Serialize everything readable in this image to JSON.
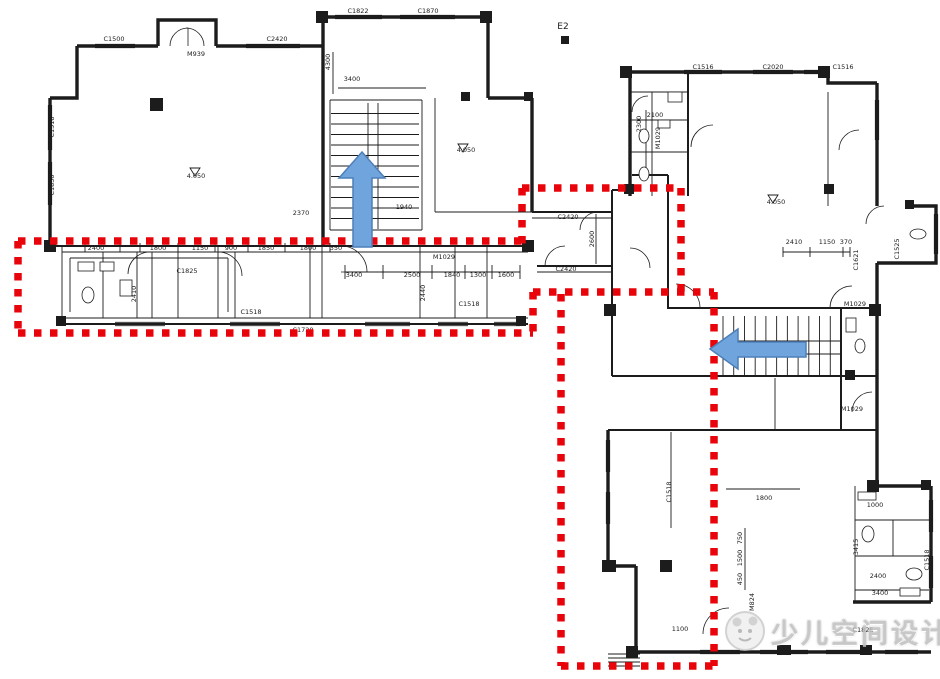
{
  "watermark": {
    "text": "少儿空间设计"
  },
  "colors": {
    "ink": "#1c1c1c",
    "highlight_red": "#e8040a",
    "arrow_blue": "#6fa4dc",
    "arrow_border": "#4e7fb8",
    "watermark_gray": "#bcbcbc",
    "background": "#ffffff"
  },
  "annotations": {
    "red_outline": {
      "color": "#e8040a",
      "segments": [
        [
          18,
          241,
          522,
          241
        ],
        [
          18,
          241,
          18,
          333
        ],
        [
          18,
          333,
          533,
          333
        ],
        [
          522,
          188,
          522,
          246
        ],
        [
          522,
          188,
          681,
          188
        ],
        [
          681,
          188,
          681,
          296
        ],
        [
          533,
          292,
          714,
          292
        ],
        [
          533,
          292,
          533,
          333
        ],
        [
          714,
          292,
          714,
          666
        ],
        [
          561,
          294,
          561,
          666
        ],
        [
          561,
          666,
          714,
          666
        ]
      ]
    },
    "arrows": [
      {
        "name": "stair-up-arrow",
        "direction": "up",
        "d": "M362,152 L385,178 L372,178 L372,247 L353,247 L353,178 L339,178 Z"
      },
      {
        "name": "stair-left-arrow",
        "direction": "left",
        "d": "M710,349 L738,329 L738,342 L806,342 L806,357 L738,357 L738,369 Z"
      }
    ]
  },
  "plan": {
    "walls_thick": [
      "M77,46 H158",
      "M216,46 H323",
      "M158,46 V20 H216 V46",
      "M77,46 V98 H50",
      "M50,98 V246",
      "M323,17 H488",
      "M323,17 V246",
      "M488,17 V98",
      "M488,98 H532",
      "M532,98 V212",
      "M632,72 H828",
      "M630,72 V196",
      "M828,72 V83 H877",
      "M877,83 V206",
      "M877,263 V486",
      "M905,206 H936 V263 H877",
      "M869,486 H931",
      "M931,486 V602",
      "M853,602 H931",
      "M608,430 V566",
      "M608,566 H636",
      "M636,566 V652",
      "M636,652 H931"
    ],
    "walls_medium": [
      "M50,246 H532",
      "M62,324 H528",
      "M532,212 H612",
      "M537,266 H612",
      "M612,190 V313",
      "M612,190 H632",
      "M668,175 V308",
      "M632,175 H668",
      "M667,308 H877",
      "M612,313 V376",
      "M612,376 H877",
      "M608,430 H877",
      "M688,72 V196",
      "M841,308 V430"
    ],
    "walls_thin": [
      "M62,252 H528",
      "M62,318 H528",
      "M62,246 V324",
      "M103,252 V318",
      "M137,252 V318",
      "M152,252 V318",
      "M178,252 V318",
      "M218,246 V318",
      "M235,252 V318",
      "M310,246 V318",
      "M322,246 V318",
      "M420,246 V318",
      "M455,246 V318",
      "M487,246 V318",
      "M70,258 H228",
      "M70,258 V312",
      "M228,258 V312",
      "M330,100 H422",
      "M330,100 V230",
      "M422,100 V230",
      "M330,230 H422",
      "M435,98 V212",
      "M435,212 H532",
      "M532,218 H612",
      "M537,272 H612",
      "M630,92 H688",
      "M652,92 V196",
      "M630,120 H688",
      "M630,152 H688",
      "M828,92 V206",
      "M775,378 V430",
      "M855,486 V602",
      "M855,520 H931",
      "M855,556 H931",
      "M893,520 V556",
      "M671,432 V528",
      "M723,316 V376",
      "M841,316 V376",
      "M608,654 H640",
      "M608,658 H640",
      "M608,662 H640",
      "M608,666 H640",
      "M338,88 H426",
      "M333,52 V94",
      "M783,252 H850",
      "M855,590 H929",
      "M726,489 H800",
      "M596,214 V264",
      "M646,110 V178",
      "M345,272 H520",
      "M745,528 V590",
      "M85,243 V252",
      "M120,243 V252",
      "M140,243 V252",
      "M178,243 V252",
      "M215,243 V252",
      "M248,243 V252",
      "M285,243 V252",
      "M330,243 V252",
      "M345,265 V279",
      "M383,265 V279",
      "M432,265 V279",
      "M465,265 V279",
      "M492,265 V279",
      "M520,265 V279",
      "M783,247 V257",
      "M810,247 V257",
      "M843,247 V257",
      "M850,247 V257",
      "M190,168 h10 l-5,8 z",
      "M458,144 h10 l-5,8 z",
      "M768,195 h10 l-5,8 z"
    ],
    "windows": [
      [
        95,
        46,
        135,
        46
      ],
      [
        246,
        46,
        300,
        46
      ],
      [
        335,
        17,
        382,
        17
      ],
      [
        400,
        17,
        455,
        17
      ],
      [
        50,
        105,
        50,
        150
      ],
      [
        50,
        162,
        50,
        205
      ],
      [
        115,
        324,
        165,
        324
      ],
      [
        230,
        324,
        280,
        324
      ],
      [
        365,
        324,
        410,
        324
      ],
      [
        438,
        324,
        468,
        324
      ],
      [
        494,
        324,
        520,
        324
      ],
      [
        684,
        72,
        722,
        72
      ],
      [
        753,
        72,
        793,
        72
      ],
      [
        804,
        72,
        826,
        72
      ],
      [
        877,
        100,
        877,
        140
      ],
      [
        936,
        214,
        936,
        254
      ],
      [
        608,
        440,
        608,
        472
      ],
      [
        608,
        492,
        608,
        524
      ],
      [
        931,
        500,
        931,
        532
      ],
      [
        931,
        556,
        931,
        588
      ],
      [
        700,
        652,
        740,
        652
      ],
      [
        760,
        652,
        808,
        652
      ],
      [
        826,
        652,
        868,
        652
      ],
      [
        885,
        652,
        918,
        652
      ]
    ],
    "doors": [
      "M170,46 A18,18 0 0,1 188,28 L188,46",
      "M204,46 A18,18 0 0,0 186,28",
      "M341,246 A26,26 0 0,1 367,272 L341,272",
      "M150,252 A22,22 0 0,0 128,274",
      "M218,252 A24,24 0 0,1 242,276",
      "M545,266 A20,20 0 0,1 565,246",
      "M598,212 A18,18 0 0,0 580,230",
      "M700,308 A24,24 0 0,0 676,284",
      "M830,308 A22,22 0 0,1 852,286",
      "M650,268 A20,20 0 0,0 630,248",
      "M691,147 A22,22 0 0,1 713,125",
      "M839,150 A20,20 0 0,1 859,130",
      "M852,412 A20,20 0 0,1 872,392",
      "M703,634 A26,26 0 0,1 729,608",
      "M648,96 A16,16 0 0,0 632,112",
      "M884,206 A18,18 0 0,0 866,224"
    ],
    "columns": [
      [
        150,
        98,
        13,
        13
      ],
      [
        316,
        11,
        12,
        12
      ],
      [
        480,
        11,
        12,
        12
      ],
      [
        44,
        240,
        12,
        12
      ],
      [
        522,
        240,
        12,
        12
      ],
      [
        56,
        316,
        10,
        10
      ],
      [
        516,
        316,
        10,
        10
      ],
      [
        620,
        66,
        12,
        12
      ],
      [
        818,
        66,
        12,
        12
      ],
      [
        624,
        184,
        10,
        10
      ],
      [
        824,
        184,
        10,
        10
      ],
      [
        604,
        304,
        12,
        12
      ],
      [
        869,
        304,
        12,
        12
      ],
      [
        602,
        560,
        14,
        12
      ],
      [
        660,
        560,
        12,
        12
      ],
      [
        867,
        480,
        12,
        12
      ],
      [
        921,
        480,
        10,
        10
      ],
      [
        777,
        645,
        14,
        10
      ],
      [
        860,
        645,
        12,
        10
      ],
      [
        626,
        646,
        12,
        12
      ],
      [
        561,
        36,
        8,
        8
      ],
      [
        461,
        92,
        9,
        9
      ],
      [
        524,
        92,
        9,
        9
      ],
      [
        905,
        200,
        9,
        9
      ],
      [
        845,
        370,
        10,
        10
      ]
    ],
    "fixtures": [
      {
        "s": "rect",
        "x": 78,
        "y": 262,
        "w": 16,
        "h": 9
      },
      {
        "s": "rect",
        "x": 100,
        "y": 262,
        "w": 14,
        "h": 9
      },
      {
        "s": "ellipse",
        "cx": 88,
        "cy": 295,
        "rx": 6,
        "ry": 8
      },
      {
        "s": "rect",
        "x": 120,
        "y": 280,
        "w": 12,
        "h": 16
      },
      {
        "s": "ellipse",
        "cx": 644,
        "cy": 136,
        "rx": 5,
        "ry": 7
      },
      {
        "s": "ellipse",
        "cx": 644,
        "cy": 174,
        "rx": 5,
        "ry": 7
      },
      {
        "s": "rect",
        "x": 658,
        "y": 120,
        "w": 12,
        "h": 8
      },
      {
        "s": "rect",
        "x": 668,
        "y": 92,
        "w": 14,
        "h": 10
      },
      {
        "s": "ellipse",
        "cx": 918,
        "cy": 234,
        "rx": 8,
        "ry": 5
      },
      {
        "s": "rect",
        "x": 858,
        "y": 492,
        "w": 18,
        "h": 8
      },
      {
        "s": "ellipse",
        "cx": 868,
        "cy": 534,
        "rx": 6,
        "ry": 8
      },
      {
        "s": "ellipse",
        "cx": 914,
        "cy": 574,
        "rx": 8,
        "ry": 6
      },
      {
        "s": "rect",
        "x": 900,
        "y": 588,
        "w": 20,
        "h": 8
      },
      {
        "s": "rect",
        "x": 846,
        "y": 318,
        "w": 10,
        "h": 14
      },
      {
        "s": "ellipse",
        "cx": 860,
        "cy": 346,
        "rx": 5,
        "ry": 7
      }
    ],
    "stairs": [
      {
        "x": 331,
        "y": 103,
        "w": 88,
        "h": 126,
        "dir": "v",
        "steps": 12,
        "rails": [
          368,
          378
        ]
      },
      {
        "x": 723,
        "y": 316,
        "w": 118,
        "h": 60,
        "dir": "h",
        "steps": 11,
        "rails": [
          341,
          354
        ]
      }
    ],
    "labels": [
      {
        "t": "C1500",
        "x": 114,
        "y": 41
      },
      {
        "t": "M939",
        "x": 196,
        "y": 56
      },
      {
        "t": "C2420",
        "x": 277,
        "y": 41
      },
      {
        "t": "C1822",
        "x": 358,
        "y": 13
      },
      {
        "t": "C1870",
        "x": 428,
        "y": 13
      },
      {
        "t": "E2",
        "x": 563,
        "y": 29,
        "s": 9
      },
      {
        "t": "C1516",
        "x": 703,
        "y": 69
      },
      {
        "t": "C2020",
        "x": 773,
        "y": 69
      },
      {
        "t": "C1516",
        "x": 843,
        "y": 69
      },
      {
        "t": "C1518",
        "x": 54,
        "y": 127,
        "r": -90
      },
      {
        "t": "C1830",
        "x": 54,
        "y": 185,
        "r": -90
      },
      {
        "t": "4.050",
        "x": 196,
        "y": 178
      },
      {
        "t": "3400",
        "x": 352,
        "y": 81
      },
      {
        "t": "4300",
        "x": 330,
        "y": 62,
        "r": -90
      },
      {
        "t": "2370",
        "x": 301,
        "y": 215
      },
      {
        "t": "1940",
        "x": 404,
        "y": 209
      },
      {
        "t": "4.050",
        "x": 466,
        "y": 152
      },
      {
        "t": "2400",
        "x": 96,
        "y": 250
      },
      {
        "t": "1800",
        "x": 158,
        "y": 250
      },
      {
        "t": "1150",
        "x": 200,
        "y": 250
      },
      {
        "t": "900",
        "x": 231,
        "y": 250
      },
      {
        "t": "1850",
        "x": 266,
        "y": 250
      },
      {
        "t": "1800",
        "x": 308,
        "y": 250
      },
      {
        "t": "350",
        "x": 336,
        "y": 250
      },
      {
        "t": "3400",
        "x": 354,
        "y": 277
      },
      {
        "t": "2500",
        "x": 412,
        "y": 277
      },
      {
        "t": "1840",
        "x": 452,
        "y": 277
      },
      {
        "t": "1300",
        "x": 478,
        "y": 277
      },
      {
        "t": "1600",
        "x": 506,
        "y": 277
      },
      {
        "t": "C1825",
        "x": 187,
        "y": 273
      },
      {
        "t": "M1029",
        "x": 444,
        "y": 259
      },
      {
        "t": "2440",
        "x": 425,
        "y": 293,
        "r": -90
      },
      {
        "t": "2410",
        "x": 136,
        "y": 294,
        "r": -90
      },
      {
        "t": "C1518",
        "x": 251,
        "y": 314
      },
      {
        "t": "C1518",
        "x": 469,
        "y": 306
      },
      {
        "t": "C1720",
        "x": 303,
        "y": 332
      },
      {
        "t": "C2420",
        "x": 568,
        "y": 219
      },
      {
        "t": "C2420",
        "x": 566,
        "y": 271
      },
      {
        "t": "2600",
        "x": 594,
        "y": 239,
        "r": -90
      },
      {
        "t": "2100",
        "x": 655,
        "y": 117
      },
      {
        "t": "2300",
        "x": 641,
        "y": 124,
        "r": -90
      },
      {
        "t": "M1029",
        "x": 660,
        "y": 138,
        "r": -90
      },
      {
        "t": "4.050",
        "x": 776,
        "y": 204
      },
      {
        "t": "2410",
        "x": 794,
        "y": 244
      },
      {
        "t": "1150",
        "x": 827,
        "y": 244
      },
      {
        "t": "370",
        "x": 846,
        "y": 244
      },
      {
        "t": "C1621",
        "x": 858,
        "y": 260,
        "r": -90
      },
      {
        "t": "C1525",
        "x": 899,
        "y": 249,
        "r": -90
      },
      {
        "t": "M1029",
        "x": 855,
        "y": 306
      },
      {
        "t": "M1029",
        "x": 852,
        "y": 411
      },
      {
        "t": "C1518",
        "x": 671,
        "y": 492,
        "r": -90
      },
      {
        "t": "1800",
        "x": 764,
        "y": 500
      },
      {
        "t": "1000",
        "x": 875,
        "y": 507
      },
      {
        "t": "750",
        "x": 742,
        "y": 538,
        "r": -90
      },
      {
        "t": "1500",
        "x": 742,
        "y": 558,
        "r": -90
      },
      {
        "t": "450",
        "x": 742,
        "y": 579,
        "r": -90
      },
      {
        "t": "3415",
        "x": 858,
        "y": 547,
        "r": -90
      },
      {
        "t": "2400",
        "x": 878,
        "y": 578
      },
      {
        "t": "M824",
        "x": 754,
        "y": 602,
        "r": -90
      },
      {
        "t": "3400",
        "x": 880,
        "y": 595
      },
      {
        "t": "1100",
        "x": 680,
        "y": 631
      },
      {
        "t": "C1825",
        "x": 863,
        "y": 632
      },
      {
        "t": "C1518",
        "x": 929,
        "y": 560,
        "r": -90
      }
    ]
  }
}
